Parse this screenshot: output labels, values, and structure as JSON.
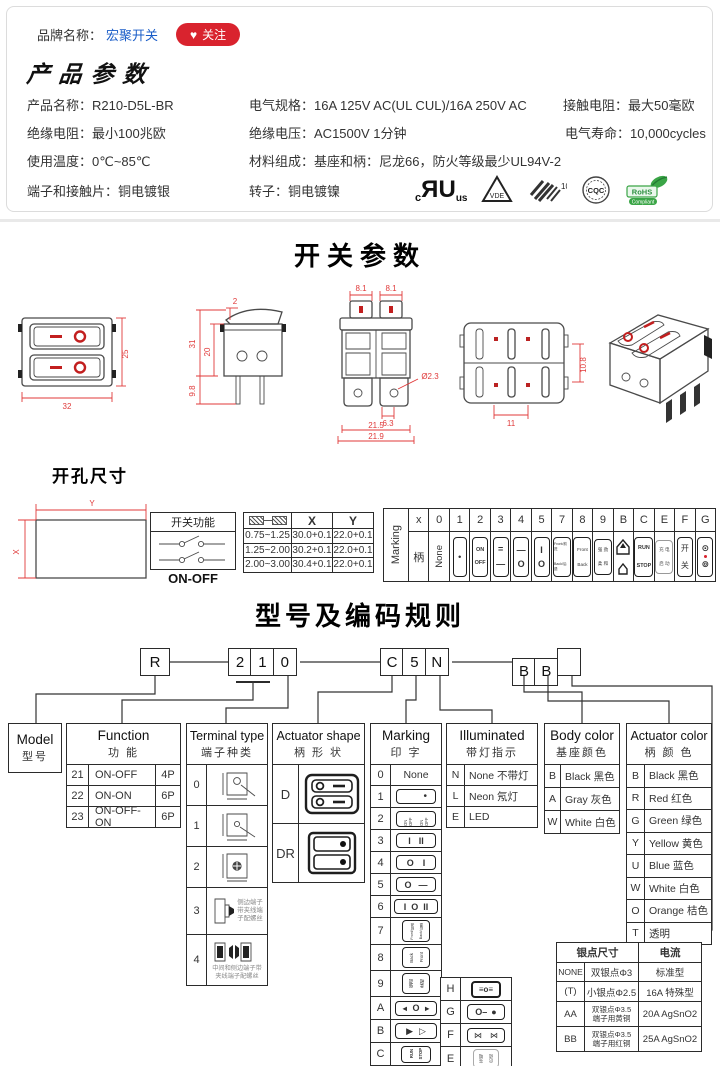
{
  "brand_bar": {
    "label": "品牌名称：",
    "brand_name": "宏聚开关",
    "follow_label": "关注",
    "heart_icon": "♥"
  },
  "product": {
    "title": "产品参数",
    "specs": [
      {
        "label": "产品名称：",
        "value": "R210-D5L-BR"
      },
      {
        "label": "电气规格：",
        "value": "16A  125V  AC(UL CUL)/16A 250V  AC"
      },
      {
        "label": "接触电阻：",
        "value": "最大50毫欧"
      },
      {
        "label": "绝缘电阻：",
        "value": "最小100兆欧"
      },
      {
        "label": "绝缘电压：",
        "value": "AC1500V 1分钟"
      },
      {
        "label": "电气寿命：",
        "value": "10,000cycles"
      },
      {
        "label": "使用温度：",
        "value": "0℃~85℃"
      },
      {
        "label": "材料组成：",
        "value": "基座和柄：尼龙66，防火等级最少UL94V-2"
      },
      {
        "label": "端子和接触片：",
        "value": "铜电镀银"
      },
      {
        "label": "转子：",
        "value": "铜电镀镍"
      }
    ],
    "certs": {
      "ul_c": "c",
      "ul_r": "R",
      "ul_u": "U",
      "ul_us": "us",
      "vde": "VDE",
      "enec": "10",
      "cqc": "CQC",
      "rohs": "RoHS",
      "rohs_sub": "Compliant"
    }
  },
  "switch_drawings": {
    "title": "开关参数",
    "front": {
      "w": "32",
      "h": "25"
    },
    "side": {
      "t": "2",
      "m": "20",
      "h": "31",
      "b": "9.8"
    },
    "top": {
      "b1": "8.1",
      "b2": "8.1",
      "hole": "Ø2.3",
      "pitch": "6.3",
      "w1": "21.5",
      "w2": "21.9"
    },
    "back": {
      "h": "10.8",
      "w": "11"
    }
  },
  "hole": {
    "title": "开孔尺寸",
    "dim_x": "X",
    "dim_y": "Y",
    "func_title": "开关功能",
    "func_label": "ON-OFF",
    "xy": {
      "hx": "X",
      "hy": "Y",
      "rows": [
        {
          "t": "0.75~1.25",
          "x": "30.0+0.1",
          "y": "22.0+0.1"
        },
        {
          "t": "1.25~2.00",
          "x": "30.2+0.1",
          "y": "22.0+0.1"
        },
        {
          "t": "2.00~3.00",
          "x": "30.4+0.1",
          "y": "22.0+0.1"
        }
      ]
    }
  },
  "marking": {
    "side_label": "Marking",
    "hx": "x",
    "handle": "柄",
    "none": "None",
    "keys": {
      "k0": "0",
      "k1": "1",
      "k2": "2",
      "k3": "3",
      "k4": "4",
      "k5": "5",
      "k7": "7",
      "k8": "8",
      "k9": "9",
      "kB": "B",
      "kC": "C",
      "kE": "E",
      "kF": "F",
      "kG": "G"
    },
    "icons": {
      "i1": "•",
      "i2a": "ON",
      "i2b": "OFF",
      "i3a": "=",
      "i3b": "—",
      "i4a": "—",
      "i4b": "O",
      "i5a": "I",
      "i5b": "O",
      "i7a": "Front/前进",
      "i7b": "Back/后退",
      "i8a": "Front",
      "i8b": "Back",
      "i9a": "强 劲",
      "i9b": "柔 和",
      "iCa": "RUN",
      "iCb": "STOP",
      "iEa": "充 电",
      "iEb": "启 动",
      "iFa": "开",
      "iFb": "关",
      "iGa": "⊙",
      "iGb": "⊚"
    }
  },
  "model": {
    "title": "型号及编码规则",
    "code": {
      "r": "R",
      "d1": "2",
      "d2": "1",
      "d3": "0",
      "m1": "C",
      "m2": "5",
      "m3": "N",
      "b1": "B",
      "b2": "B",
      "b3": ""
    },
    "cols": {
      "model": {
        "en": "Model",
        "cn": "型号"
      },
      "function": {
        "en": "Function",
        "cn": "功  能",
        "rows": [
          {
            "k": "21",
            "v": "ON-OFF",
            "p": "4P"
          },
          {
            "k": "22",
            "v": "ON-ON",
            "p": "6P"
          },
          {
            "k": "23",
            "v": "ON-OFF-ON",
            "p": "6P"
          }
        ]
      },
      "terminal": {
        "en": "Terminal type",
        "cn": "端子种类",
        "k0": "0",
        "k1": "1",
        "k2": "2",
        "k3": "3",
        "k4": "4",
        "note3a": "侧边端子",
        "note3b": "带夹线端",
        "note3c": "子配螺丝",
        "note4a": "中间和侧边端子带",
        "note4b": "夹线端子配螺丝"
      },
      "shape": {
        "en": "Actuator shape",
        "cn": "柄 形 状",
        "kD": "D",
        "kDR": "DR"
      },
      "marking": {
        "en": "Marking",
        "cn": "印  字"
      },
      "illum": {
        "en": "Illuminated",
        "cn": "带灯指示",
        "rows": [
          {
            "k": "N",
            "v": "None 不带灯"
          },
          {
            "k": "L",
            "v": "Neon 氖灯"
          },
          {
            "k": "E",
            "v": "LED"
          }
        ]
      },
      "body": {
        "en": "Body color",
        "cn": "基座颜色",
        "rows": [
          {
            "k": "B",
            "v": "Black 黑色"
          },
          {
            "k": "A",
            "v": "Gray 灰色"
          },
          {
            "k": "W",
            "v": "White 白色"
          }
        ]
      },
      "act": {
        "en": "Actuator color",
        "cn": "柄 颜 色",
        "rows": [
          {
            "k": "B",
            "v": "Black 黑色"
          },
          {
            "k": "R",
            "v": "Red  红色"
          },
          {
            "k": "G",
            "v": "Green 绿色"
          },
          {
            "k": "Y",
            "v": "Yellow 黄色"
          },
          {
            "k": "U",
            "v": "Blue 蓝色"
          },
          {
            "k": "W",
            "v": "White 白色"
          },
          {
            "k": "O",
            "v": "Orange 桔色"
          },
          {
            "k": "T",
            "v": "透明"
          }
        ]
      }
    },
    "mk_rows": [
      {
        "k": "0",
        "t": "None"
      },
      {
        "k": "1",
        "a": "•"
      },
      {
        "k": "2",
        "a": "ON OFF",
        "b": "ON OFF"
      },
      {
        "k": "3",
        "a": "I",
        "b": "II"
      },
      {
        "k": "4",
        "a": "O",
        "b": "I"
      },
      {
        "k": "5",
        "a": "O",
        "b": "—"
      },
      {
        "k": "6",
        "a": "I",
        "b": "O",
        "c": "II"
      },
      {
        "k": "7",
        "a": "Front/前进",
        "b": "Back/后退"
      },
      {
        "k": "8",
        "a": "Back",
        "b": "Front"
      },
      {
        "k": "9",
        "a": "强劲",
        "b": "柔和"
      },
      {
        "k": "A",
        "a": "◄",
        "b": "O",
        "c": "►"
      },
      {
        "k": "B",
        "a": "▶",
        "b": "▷"
      },
      {
        "k": "C",
        "a": "RUN",
        "b": "STOP"
      },
      {
        "k": "D",
        "a": "O",
        "b": "◄—"
      }
    ],
    "mk_right": [
      {
        "k": "H",
        "a": "≡o≡"
      },
      {
        "k": "G",
        "a": "O–",
        "b": "●"
      },
      {
        "k": "F",
        "a": "⋈",
        "b": "⋈"
      },
      {
        "k": "E",
        "a": "充电",
        "b": "启动"
      }
    ],
    "silver": {
      "h1": "银点尺寸",
      "h2": "电流",
      "rows": [
        {
          "k": "NONE",
          "d1": "双银点Φ3",
          "d2": "",
          "a": "标准型"
        },
        {
          "k": "(T)",
          "d1": "小银点Φ2.5",
          "d2": "",
          "a": "16A 特殊型"
        },
        {
          "k": "AA",
          "d1": "双银点Φ3.5",
          "d2": "端子用黄铜",
          "a": "20A AgSnO2"
        },
        {
          "k": "BB",
          "d1": "双银点Φ3.5",
          "d2": "端子用红铜",
          "a": "25A AgSnO2"
        }
      ]
    }
  }
}
